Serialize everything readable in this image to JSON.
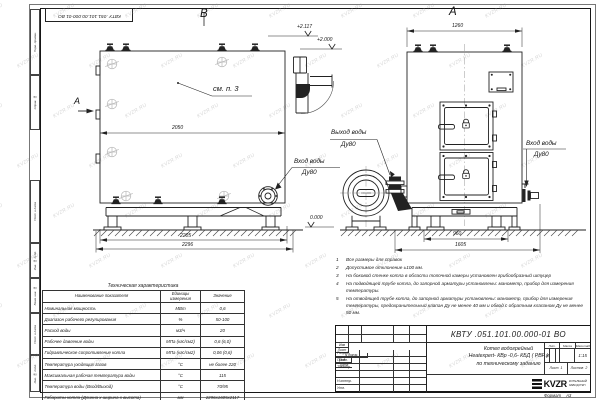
{
  "watermark": {
    "text": "KVZR.RU"
  },
  "frame": {
    "top_stamp": "КВТУ .051.101.00.000-01  ВО",
    "margin_labels": [
      "Перв. примен.",
      "Справ. №",
      "Подп. и дата",
      "Инв. № дубл.",
      "Взам. инв. №",
      "Подп. и дата",
      "Инв. № подл."
    ],
    "format_label": "Формат",
    "format_value": "А3"
  },
  "views": {
    "side": {
      "label": "В",
      "dir_label": "А",
      "callout_note": "см. п. 3",
      "dim_mid": "2050",
      "dim_base_inner": "2205",
      "dim_base_outer": "2296",
      "elev_top": "+2.117",
      "elev_flue": "+2.000",
      "elev_ground": "0.000",
      "inlet": {
        "line1": "Вход воды",
        "line2": "Ду80"
      },
      "outlet": {
        "line1": "Выход воды",
        "line2": "Ду80"
      }
    },
    "front": {
      "label": "А",
      "dim_top": "1260",
      "dim_base_inner": "960",
      "dim_base_outer": "1605",
      "inlet": {
        "line1": "Вход воды",
        "line2": "Ду80"
      }
    }
  },
  "notes": {
    "items": [
      {
        "num": "1",
        "text": "Все размеры для справок"
      },
      {
        "num": "2",
        "text": "Допустимое отклонение ±100 мм."
      },
      {
        "num": "3",
        "text": "На боковой стенке котла в области топочной камеры установлен грибообразный штуцер"
      },
      {
        "num": "4",
        "text": "На подводящей трубе котла, до запорной арматуры установлены: манометр, прибор для измерения температуры."
      },
      {
        "num": "5",
        "text": "На отводящей трубе котла, до запорной арматуры установлены: манометр, прибор для измерения температуры, предохранительный клапан Ду не менее 40 мм и обвод с обратным клапаном Ду не менее 50 мм."
      }
    ]
  },
  "spec_table": {
    "title": "Техническая характеристика",
    "headers": [
      "Наименование показателя",
      "Единицы измерения",
      "Значение"
    ],
    "rows": [
      [
        "Номинальная мощность",
        "МВт",
        "0,6"
      ],
      [
        "Диапазон рабочего регулирования",
        "%",
        "50-100"
      ],
      [
        "Расход воды",
        "м3/ч",
        "20"
      ],
      [
        "Рабочее давление воды",
        "МПа (кгс/см2)",
        "0,6 (6,0)"
      ],
      [
        "Гидравлическое сопротивление котла",
        "МПа (кгс/см2)",
        "0,06 (0,6)"
      ],
      [
        "Температура уходящих газов",
        "°С",
        "не более 220"
      ],
      [
        "Максимальная рабочая температура воды",
        "°С",
        "115"
      ],
      [
        "Температура воды (Вход/Выход)",
        "°С",
        "70/95"
      ],
      [
        "Габариты котла (Длинна х ширина х высота)",
        "мм",
        "2296х1605х2117"
      ]
    ]
  },
  "title_block": {
    "designation": "КВТУ .051.101.00.000-01  ВО",
    "name_lines": [
      "Котел водогрейный",
      "Heatexpert- КВр -0,6- КБД ( РВР )",
      "по техническому заданию"
    ],
    "sign_headers": [
      "Изм",
      "Лист",
      "N докум.",
      "Подп.",
      "Дата"
    ],
    "sign_rows": [
      "Разраб.",
      "Пров.",
      "Т.контр.",
      "",
      "Н.контр.",
      "Утв."
    ],
    "lit_headers": [
      "Лит.",
      "Масса",
      "Масштаб"
    ],
    "lit_value": "И",
    "scale": "1:15",
    "sheet": {
      "label": "Лист",
      "num": "1"
    },
    "sheets": {
      "label": "Листов",
      "num": "2"
    },
    "logo": {
      "text": "KVZR",
      "caption1": "КОТЕЛЬНЫЙ",
      "caption2": "ЗАВОД РЭП"
    }
  }
}
